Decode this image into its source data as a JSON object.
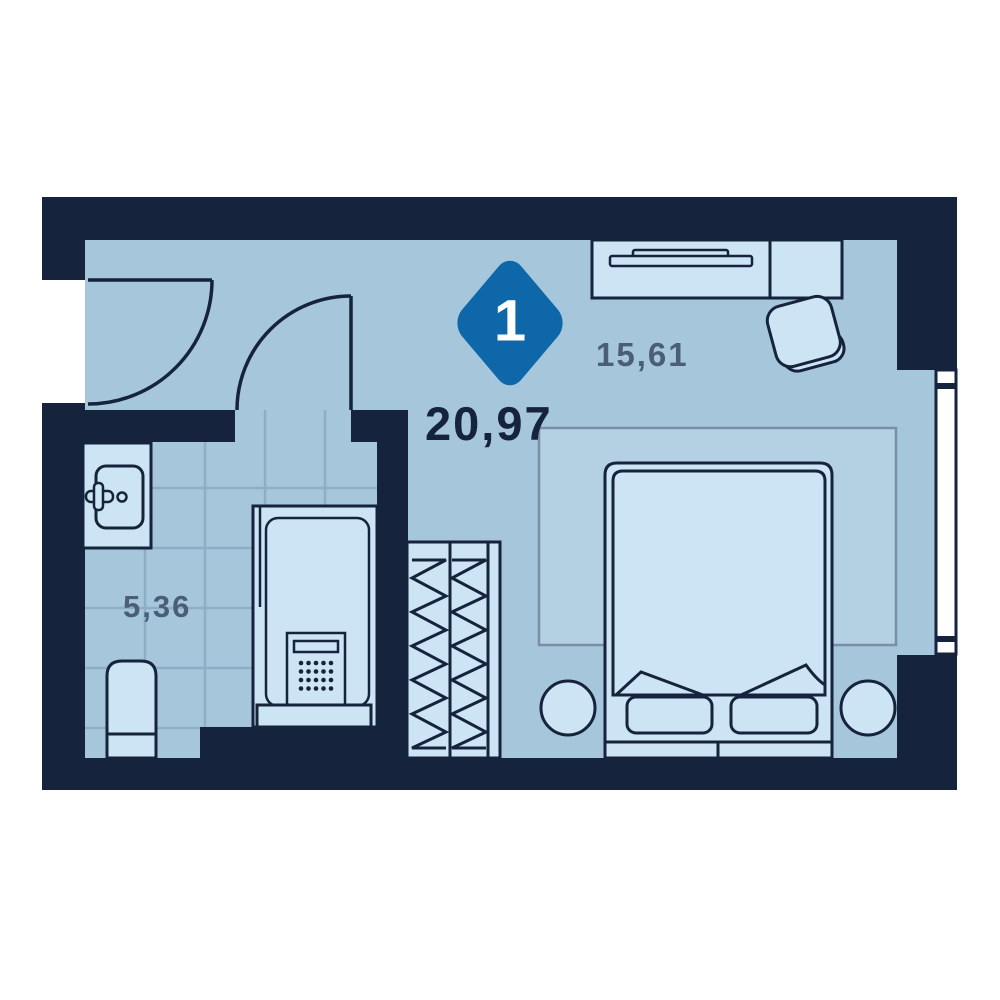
{
  "plan": {
    "type": "apartment-floor-plan",
    "room_count": "1",
    "total_area": "20,97",
    "areas": {
      "bedroom": "15,61",
      "bathroom": "5,36"
    }
  },
  "colors": {
    "wall": "#16233D",
    "floor": "#A6C6DC",
    "tile-line": "#8FAEC5",
    "furn": "#CDE4F4",
    "rug": "#B4D1E4",
    "rug-line": "#7A8FA4",
    "badge": "#0E67A8",
    "ink": "#16233E",
    "muted": "#4A5E78",
    "pane": "#FFFFFF",
    "bg": "#FFFFFF"
  },
  "furniture": [
    "entry-door",
    "bathroom-door",
    "sink-vanity",
    "toilet",
    "shower-cabin",
    "wardrobe",
    "rug",
    "bed",
    "nightstand-left",
    "nightstand-right",
    "desk",
    "laptop",
    "desk-chair",
    "window"
  ]
}
